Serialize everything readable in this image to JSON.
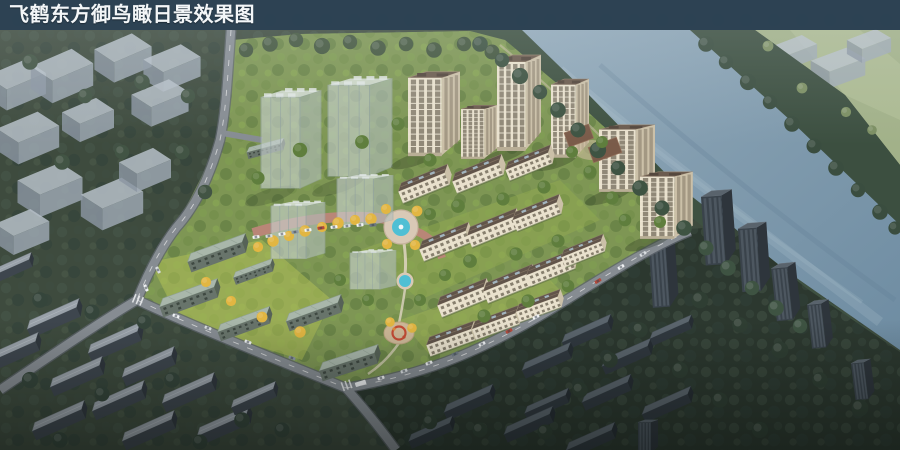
{
  "title_bar": {
    "text": "飞鹤东方御鸟瞰日景效果图"
  },
  "palette": {
    "title_bar_bg": "#2C4254",
    "title_text": "#F3F6F8",
    "water": "#7E99AC",
    "context_green": "#3E4B3E",
    "dark_zone_green": "#2C382F",
    "site_green": "#7E9654",
    "lawn_yellow_green": "#AFC055",
    "golden_tree": "#E2B642",
    "cream_facade": "#E9E1CD",
    "dark_roof_brown": "#61544A",
    "sage_roof": "#A9B7AB",
    "glass_ghost": "#C9D2D1",
    "ghost_block_gray": "#9AA5B1",
    "pool_blue": "#4FBFD4",
    "road_gray": "#868C92",
    "road_pink": "#B98677",
    "far_bank_field": "#A2B189",
    "dark_tower": "#3A434B"
  },
  "scene": {
    "type": "architectural-aerial-rendering",
    "view": "bird's-eye daytime",
    "elements": [
      "river",
      "far-bank-tree-line",
      "far-bank-field",
      "ghost-massing-blocks",
      "glass-phase-towers",
      "cream-residential-towers",
      "mid-rise-slab-rows",
      "sage-roof-slabs",
      "central-fountain-plaza",
      "small-pool",
      "children-playground",
      "boundary-roads",
      "parked-cars",
      "context-low-rise-rows",
      "dark-context-towers",
      "clubhouse",
      "riverside-promenade"
    ]
  }
}
